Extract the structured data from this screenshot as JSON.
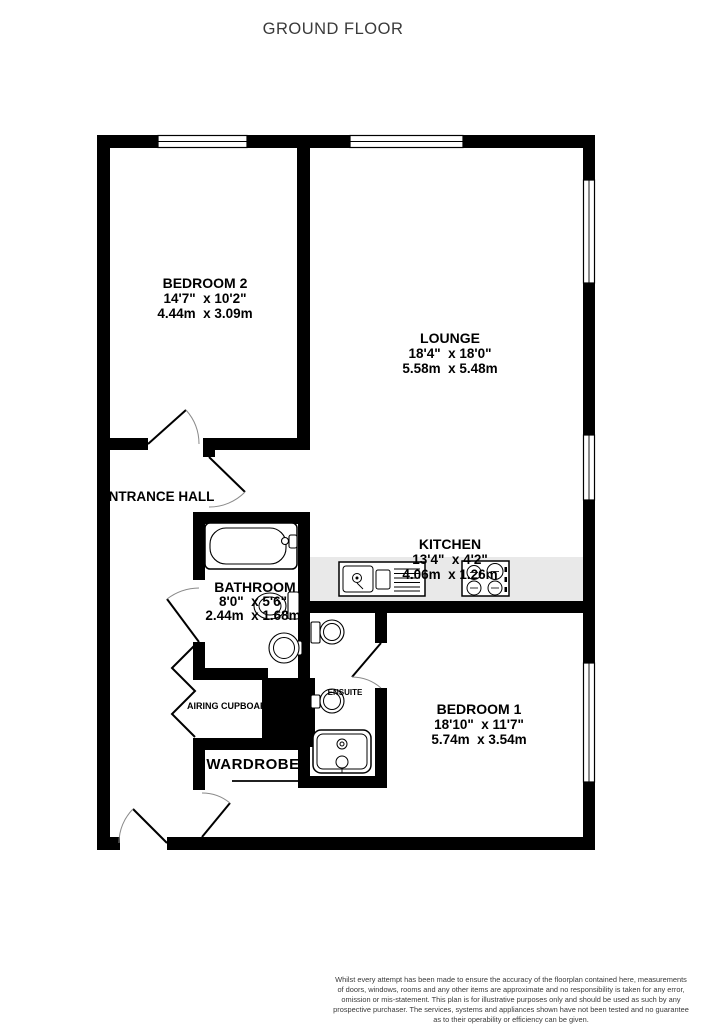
{
  "title": "GROUND FLOOR",
  "colors": {
    "wall": "#000000",
    "kitchen_counter": "#e9e9e9",
    "background": "#ffffff",
    "title_text": "#3a3a3a"
  },
  "rooms": {
    "bedroom2": {
      "name": "BEDROOM 2",
      "imperial": "14'7\"  x 10'2\"",
      "metric": "4.44m  x 3.09m"
    },
    "lounge": {
      "name": "LOUNGE",
      "imperial": "18'4\"  x 18'0\"",
      "metric": "5.58m  x 5.48m"
    },
    "kitchen": {
      "name": "KITCHEN",
      "imperial": "13'4\"  x 4'2\"",
      "metric": "4.06m  x 1.26m"
    },
    "bathroom": {
      "name": "BATHROOM",
      "imperial": "8'0\"  x 5'6\"",
      "metric": "2.44m  x 1.68m"
    },
    "bedroom1": {
      "name": "BEDROOM 1",
      "imperial": "18'10\"  x 11'7\"",
      "metric": "5.74m  x 3.54m"
    },
    "entrance_hall": {
      "name": "ENTRANCE HALL"
    },
    "airing_cupboard": {
      "name": "AIRING CUPBOARD"
    },
    "ensuite": {
      "name": "ENSUITE"
    },
    "wardrobe": {
      "name": "WARDROBE"
    }
  },
  "footer": {
    "disclaimer_lines": [
      "Whilst every attempt has been made to ensure the accuracy of the floorplan contained here, measurements",
      "of doors, windows, rooms and any other items are approximate and no responsibility is taken for any error,",
      "omission or mis-statement. This plan is for illustrative purposes only and should be used as such by any",
      "prospective purchaser. The services, systems and appliances shown have not been tested and no guarantee",
      "as to their operability or efficiency can be given."
    ],
    "credit": "Made with Metropix ©2023"
  }
}
